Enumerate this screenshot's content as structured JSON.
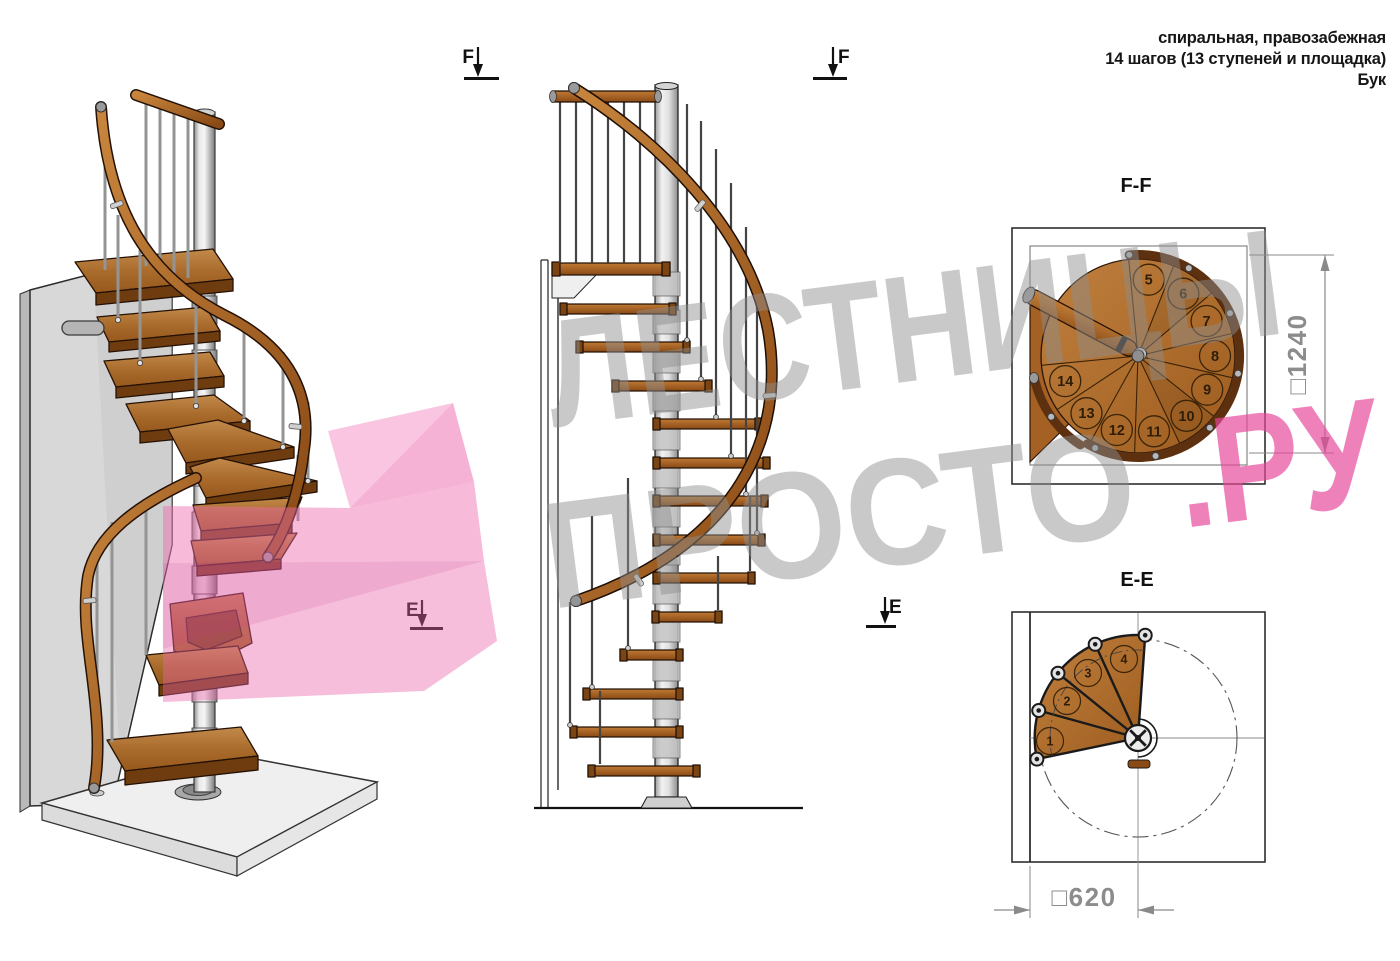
{
  "header": {
    "line1": "спиральная, правозабежная",
    "line2": "14 шагов (13 ступеней и площадка)",
    "line3": "Бук"
  },
  "section_markers": {
    "f_label": "F",
    "e_label": "E"
  },
  "views": {
    "ff": {
      "title": "F-F",
      "dimension_label": "□1240",
      "steps": [
        "5",
        "6",
        "7",
        "8",
        "9",
        "10",
        "11",
        "12",
        "13",
        "14"
      ]
    },
    "ee": {
      "title": "E-E",
      "dimension_label": "□620",
      "steps": [
        "1",
        "2",
        "3",
        "4"
      ]
    }
  },
  "watermark": {
    "line1": "ЛЕСТНИЦЫ",
    "line2_gray": "ПРОСТО",
    "line2_pink": ".РУ"
  },
  "colors": {
    "wood": "#a96a2e",
    "handrail": "#8a4a15",
    "metal_pole": "#c9c9c9",
    "watermark_gray": "#8f8f8f",
    "watermark_pink": "#e8459a",
    "dimension_gray": "#8c8c8c"
  }
}
